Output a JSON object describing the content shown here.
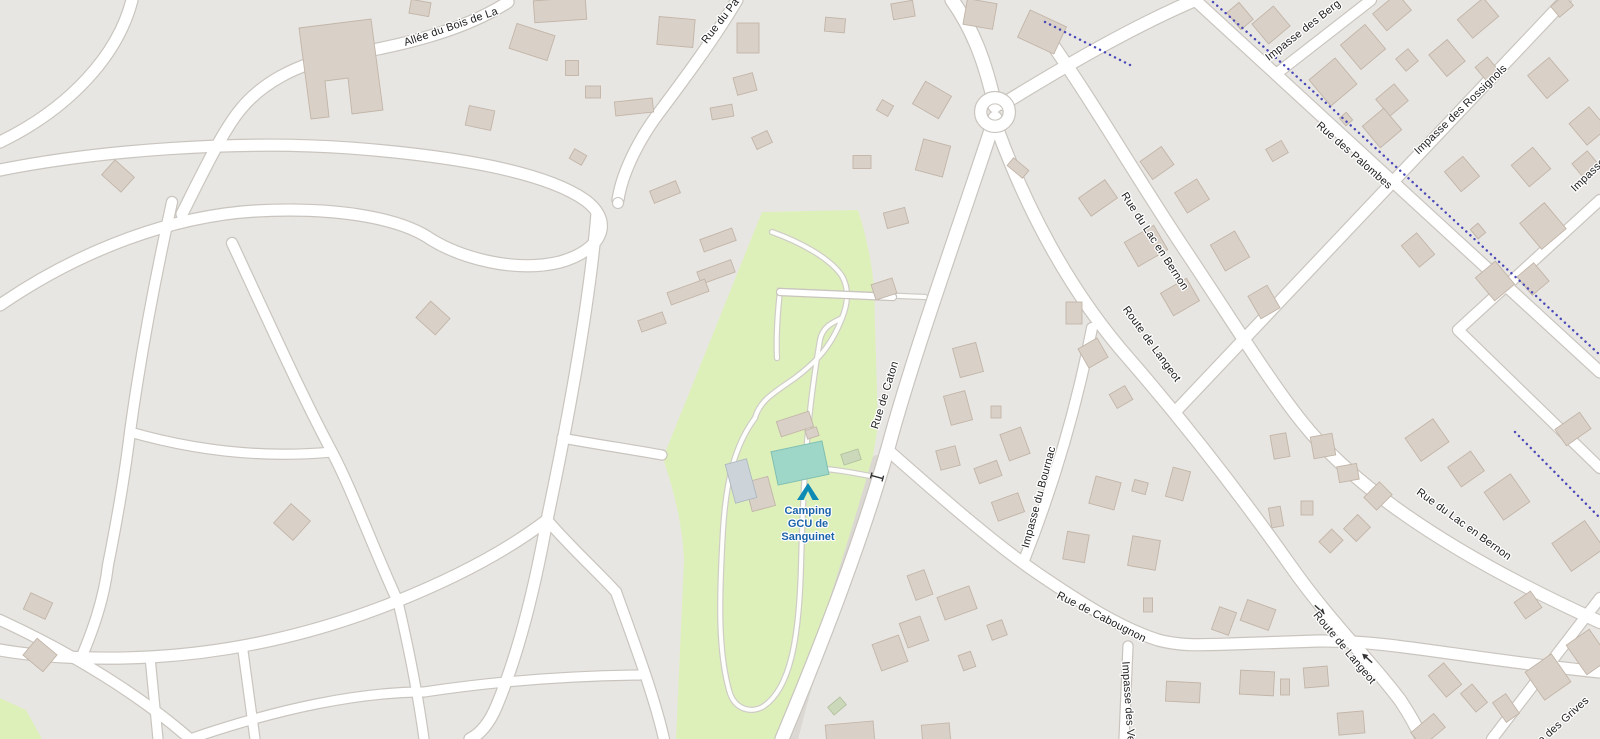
{
  "map": {
    "type": "street-map",
    "colors": {
      "background": "#e8e6e2",
      "road": "#ffffff",
      "casing": "#c9c4be",
      "building": "#d9d0c7",
      "building_stroke": "#c2b5a8",
      "camp": "#def0ba",
      "camp_path": "#fdfdfb",
      "pool": "#9ed6c8",
      "pool_stroke": "#7fbfb0",
      "dots": "#4848b8",
      "service": "#dbd8d3",
      "label": "#202020",
      "poi_label": "#1b63a8",
      "poi_icon": "#0e8bb4",
      "green_building": "#ccd8ba",
      "blue_building": "#cdd4d9"
    },
    "labels": {
      "allee_du_bois": "Allée du Bois de La",
      "rue_du_pa": "Rue du Pa",
      "rue_de_caton": "Rue de Caton",
      "rue_du_lac_en_bernon": "Rue du Lac en Bernon",
      "route_de_langeot": "Route de Langeot",
      "impasse_du_bournac": "Impasse du Bournac",
      "rue_de_cabougnon": "Rue de Cabougnon",
      "impasse_des_ve": "Impasse des Ve",
      "impasse_des_berg": "Impasse des Berg",
      "rue_des_palombes": "Rue des Palombes",
      "impasse_des_rossignols": "Impasse des Rossignols",
      "impasse_d": "Impasse d",
      "impasse_des_grives": "Impasse des Grives"
    },
    "poi": {
      "camp_site": {
        "line1": "Camping",
        "line2": "GCU de",
        "line3": "Sanguinet",
        "icon": "tent-icon"
      }
    }
  }
}
